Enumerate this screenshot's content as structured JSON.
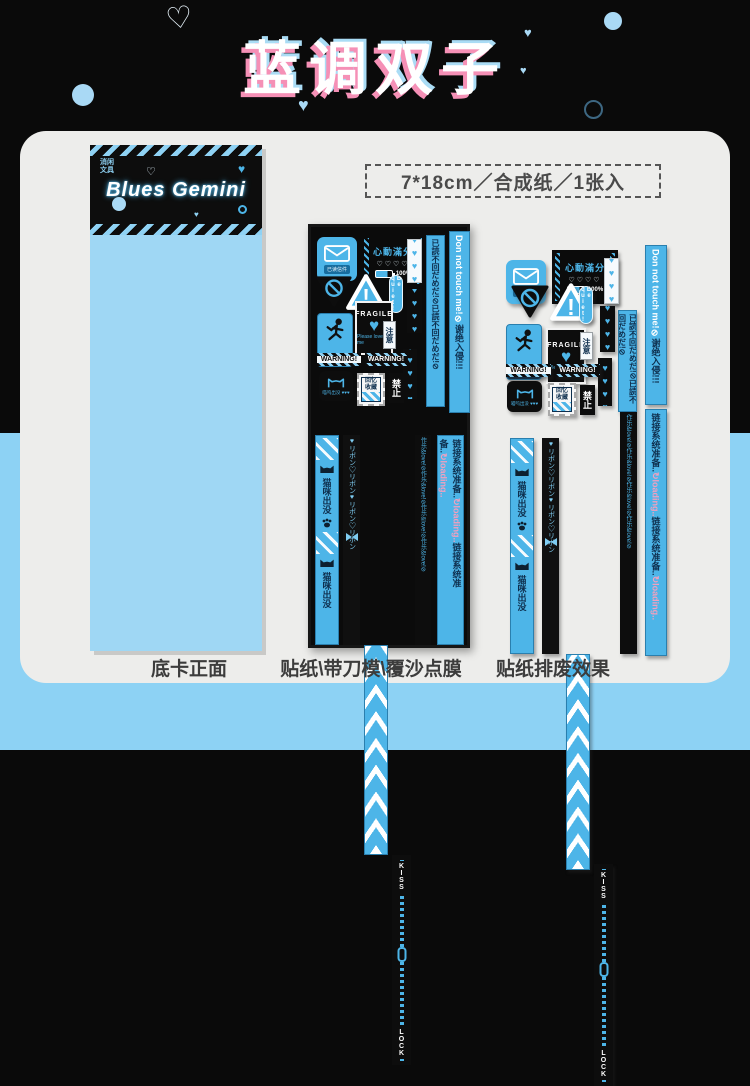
{
  "page": {
    "title": "蓝调双子",
    "spec": "7*18cm／合成纸／1张入",
    "bg_black": "#0a0a0a",
    "bg_blue": "#8dd2f4",
    "card_bg": "#ededeb",
    "accent_blue": "#4db5e8",
    "accent_pink": "#f590b6"
  },
  "bookmark": {
    "brand": "Blues Gemini",
    "logo_line1": "消闲",
    "logo_line2": "文具"
  },
  "captions": {
    "left": "底卡正面",
    "middle": "贴纸\\带刀模\\覆沙点膜",
    "right": "贴纸排废效果"
  },
  "icons": {
    "heart_filled": "♥",
    "heart_outline": "♡"
  },
  "stk": {
    "env_caption": "已读信件",
    "batt_title": "心動滿分",
    "batt_hearts": "♡♡♡♡",
    "batt_pct": "100%",
    "bang": "!",
    "be_quiet": "Be quiet!",
    "hearts4": "♥♥♥♥",
    "hearts5": "♥♥♥♥♥",
    "jp_bar": "已読不回だめだ!⊘已読不回だめだ!⊘",
    "dont_touch": "Don not touch me!",
    "slash": "⊘",
    "intrude": "谢绝入侵!!!",
    "fragile": "FRAGILE",
    "love": "Please love me",
    "fall_caption": "当心坠落",
    "attention": "注意",
    "warning": "WARNING!",
    "cat_caption": "喵呜出没 ♥♥♥",
    "stamp_line1": "回忆",
    "stamp_line2": "收藏",
    "forbid": "禁止",
    "strip_cat": "猫咪出没",
    "strip_ribbon": "♥リボン♡リボン♥リボン♡リボン",
    "strip_kiss": "KISS",
    "strip_lock": "LOCK",
    "strip_dense": "作乐&love!⊘作乐&love!⊘作乐&love!⊘作乐&love!⊘",
    "loading_text": "链接系统准备..",
    "loading_pink": "↻loading.."
  }
}
